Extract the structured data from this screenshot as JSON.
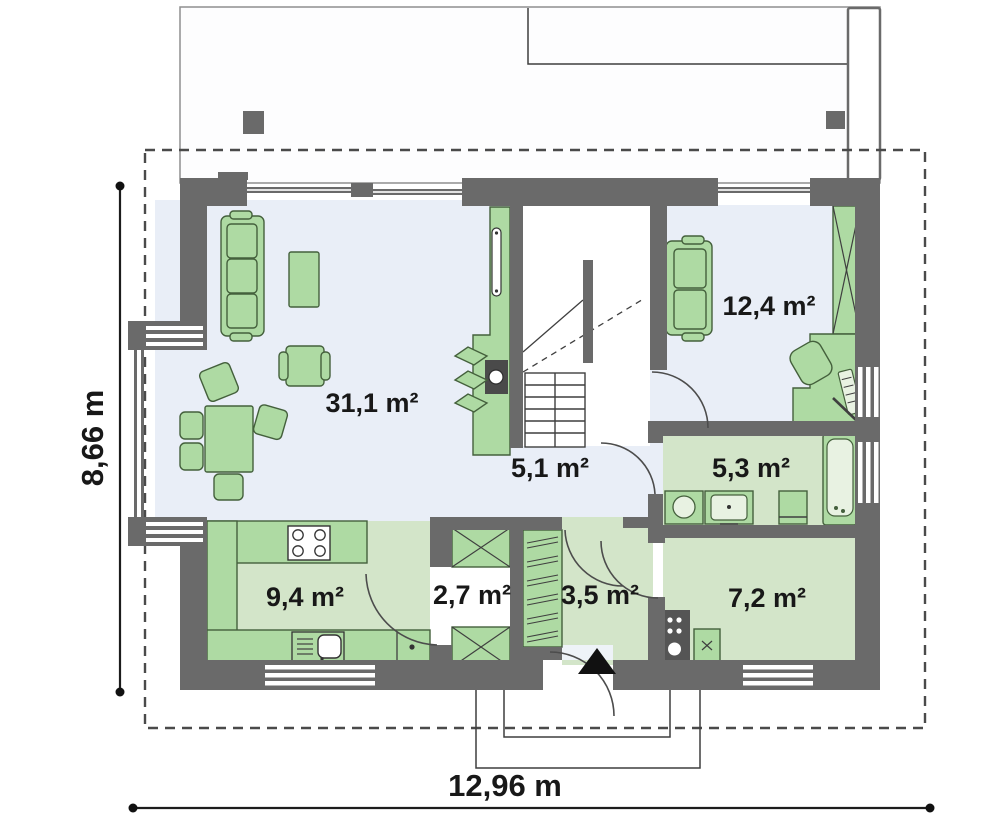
{
  "plan": {
    "title": "house-ground-floor-plan",
    "rooms": [
      {
        "name": "living-room",
        "label": "31,1 m²"
      },
      {
        "name": "bedroom",
        "label": "12,4 m²"
      },
      {
        "name": "hall",
        "label": "5,1 m²"
      },
      {
        "name": "bathroom",
        "label": "5,3 m²"
      },
      {
        "name": "kitchen",
        "label": "9,4 m²"
      },
      {
        "name": "pantry",
        "label": "2,7 m²"
      },
      {
        "name": "entry",
        "label": "3,5 m²"
      },
      {
        "name": "utility-room",
        "label": "7,2 m²"
      }
    ],
    "dimensions": {
      "height": "8,66 m",
      "width": "12,96 m"
    },
    "colors": {
      "wall": "#6a6a6a",
      "floor_blue": "#e9eef7",
      "floor_green": "#d3e5c9",
      "furniture_green": "#aedaa3",
      "furniture_stroke": "#44603c",
      "line_dark": "#3f3f3f"
    }
  }
}
